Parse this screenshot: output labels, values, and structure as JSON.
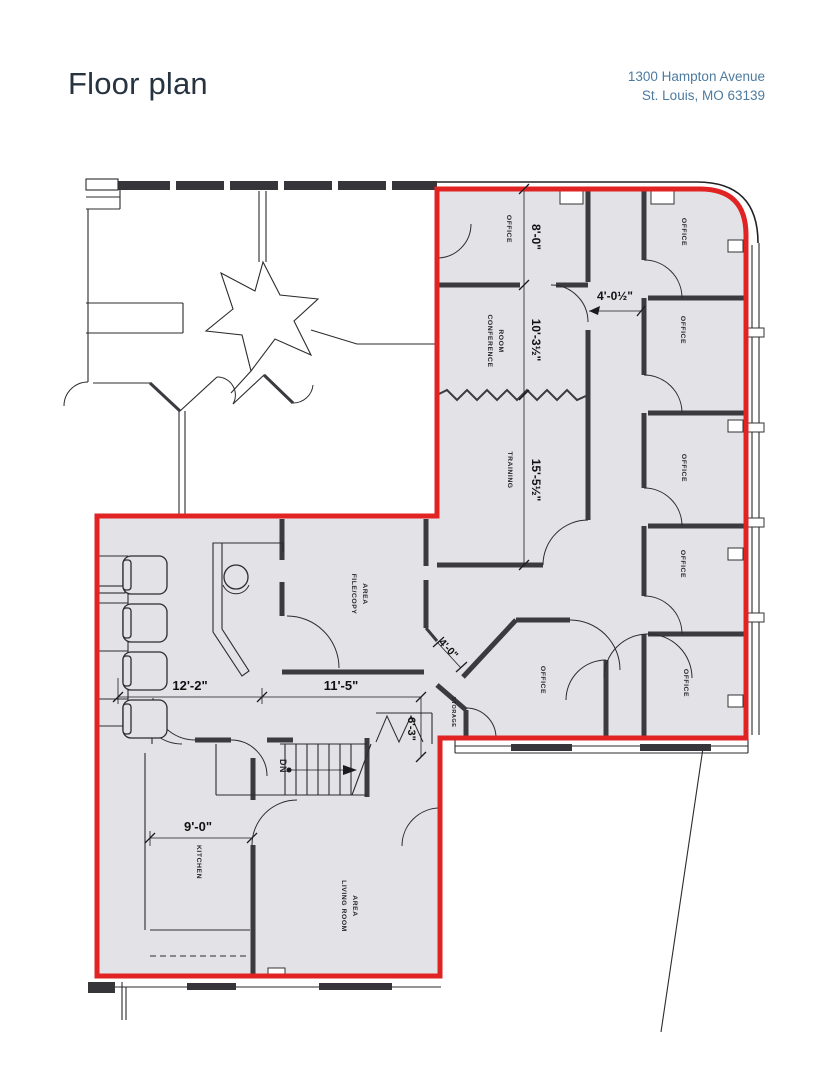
{
  "header": {
    "title": "Floor plan",
    "address_line1": "1300 Hampton Avenue",
    "address_line2": "St. Louis, MO 63139"
  },
  "plan": {
    "labels": {
      "office": "OFFICE",
      "conference_line1": "CONFERENCE",
      "conference_line2": "ROOM",
      "training": "TRAINING",
      "filecopy_line1": "FILE/COPY",
      "filecopy_line2": "AREA",
      "storage": "STORAGE",
      "kitchen": "KITCHEN",
      "living_line1": "LIVING ROOM",
      "living_line2": "AREA",
      "stairs_down": "DN"
    },
    "dimensions": {
      "office_top": "8'-0\"",
      "conference": "10'-3½\"",
      "training": "15'-5½\"",
      "entry": "4'-0½\"",
      "corridor": "4'-0\"",
      "reception": "12'-2\"",
      "filecopy": "11'-5\"",
      "closet": "6'-3\"",
      "kitchen": "9'-0\""
    },
    "colors": {
      "highlight": "#e12323",
      "floor": "#e3e3e7",
      "wall": "#3a3a3f"
    }
  }
}
